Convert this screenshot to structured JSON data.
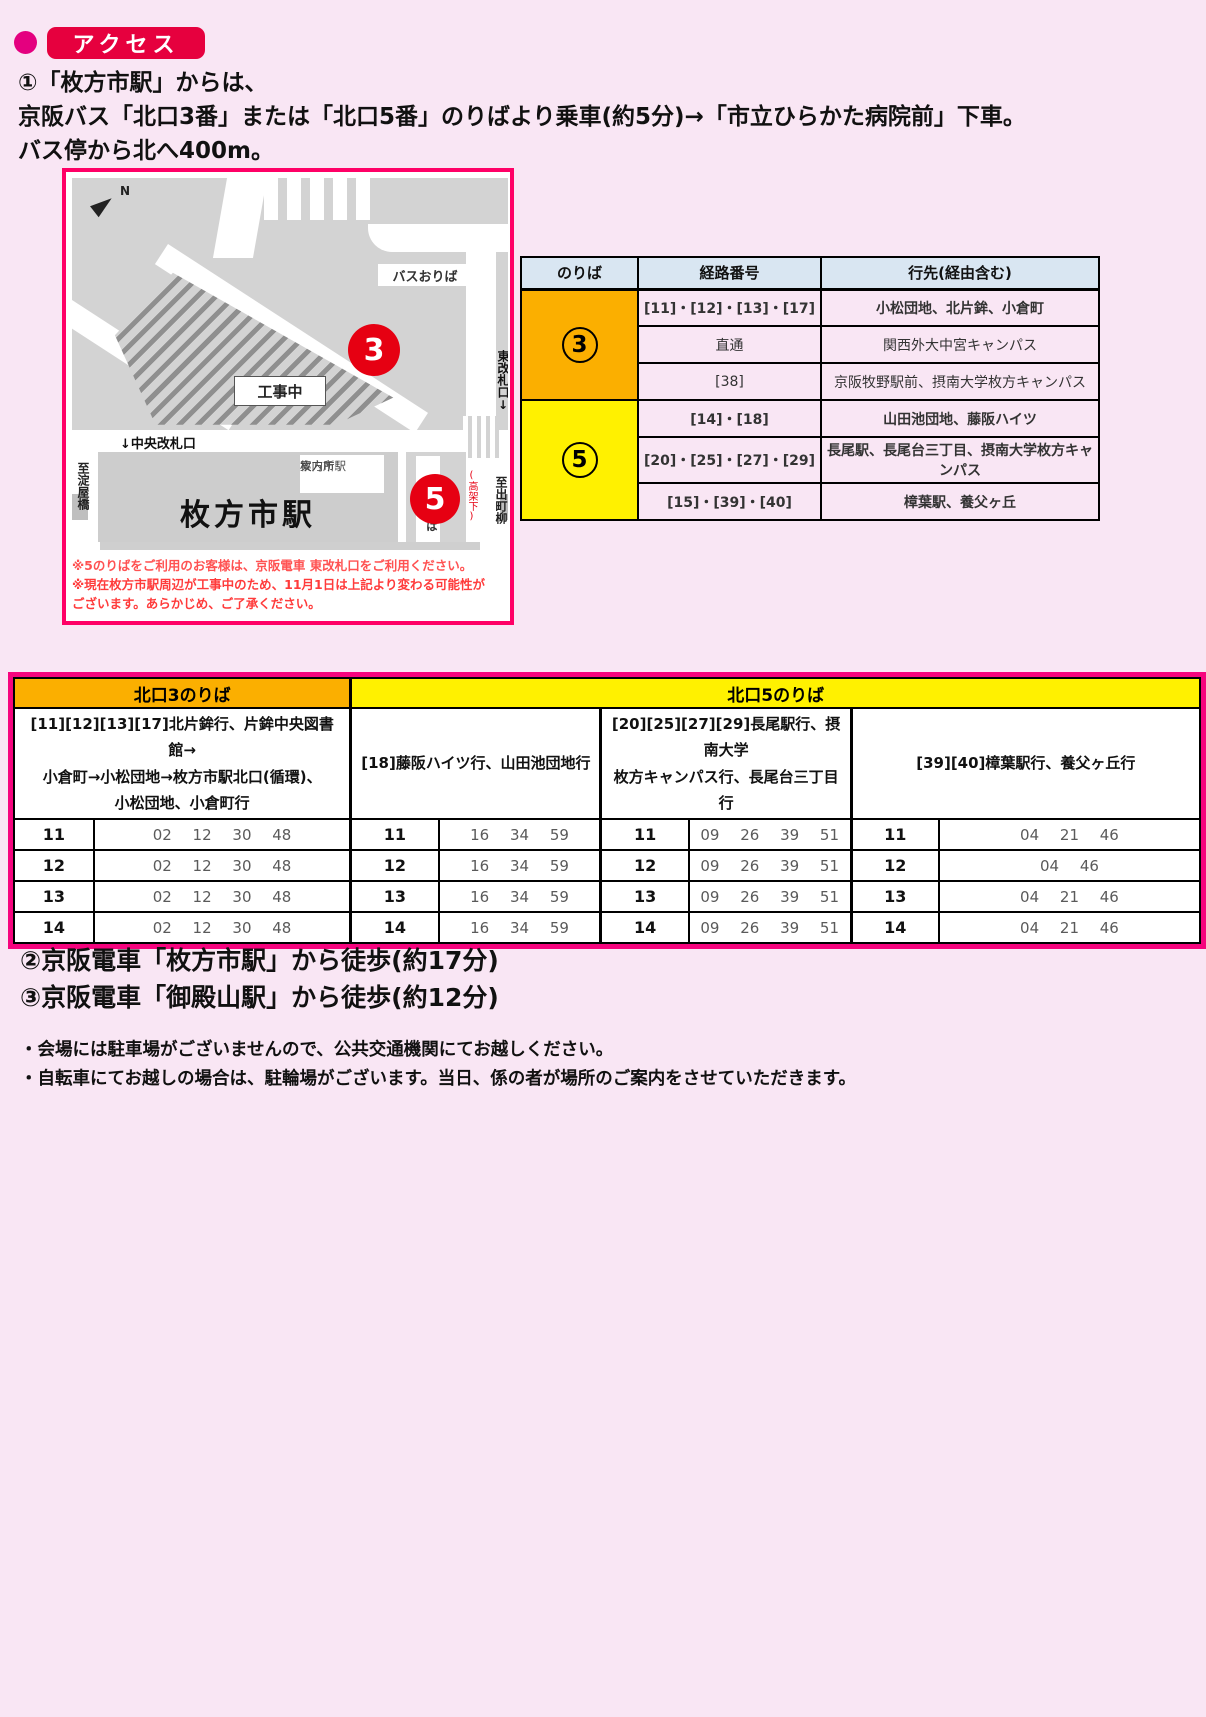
{
  "header": {
    "title": "アクセス"
  },
  "intro": {
    "line1": "①「枚方市駅」からは、",
    "line2": "京阪バス「北口3番」または「北口5番」のりばより乗車(約5分)→「市立ひらかた病院前」下車。",
    "line3": "バス停から北へ400m。"
  },
  "station_map": {
    "north_label": "N",
    "bus_dropoff_top": "バスおりば",
    "stop3_number": "3",
    "construction_label": "工事中",
    "central_gate_label": "↓中央改札口",
    "east_gate_label": "東改札口↓",
    "info_center_line1": "枚方市駅",
    "info_center_line2": "案内所",
    "station_name": "枚方市駅",
    "bus_dropoff_side": "バスおりば",
    "stop5_number": "5",
    "under_viaduct": "(高架下)",
    "to_yodoyabashi": "至淀屋橋",
    "to_demachiyanagi": "至出町柳",
    "note1": "※5のりばをご利用のお客様は、京阪電車 東改札口をご利用ください。",
    "note2": "※現在枚方市駅周辺が工事中のため、11月1日は上記より変わる可能性が",
    "note3": "ございます。あらかじめ、ご了承ください。"
  },
  "route_table": {
    "col_headers": [
      "のりば",
      "経路番号",
      "行先(経由含む)"
    ],
    "stop3": {
      "number": "3",
      "rows": [
        {
          "route": "[11]・[12]・[13]・[17]",
          "dest": "小松団地、北片鉾、小倉町"
        },
        {
          "route": "直通",
          "dest": "関西外大中宮キャンパス"
        },
        {
          "route": "[38]",
          "dest": "京阪牧野駅前、摂南大学枚方キャンパス"
        }
      ]
    },
    "stop5": {
      "number": "5",
      "rows": [
        {
          "route": "[14]・[18]",
          "dest": "山田池団地、藤阪ハイツ"
        },
        {
          "route": "[20]・[25]・[27]・[29]",
          "dest": "長尾駅、長尾台三丁目、摂南大学枚方キャンパス"
        },
        {
          "route": "[15]・[39]・[40]",
          "dest": "樟葉駅、養父ヶ丘"
        }
      ]
    }
  },
  "timetable": {
    "north3_header": "北口3のりば",
    "north5_header": "北口5のりば",
    "groups": [
      {
        "desc": "[11][12][13][17]北片鉾行、片鉾中央図書館→\n小倉町→小松団地→枚方市駅北口(循環)、\n小松団地、小倉町行",
        "rows": [
          {
            "hour": "11",
            "minutes": "02 12 30 48"
          },
          {
            "hour": "12",
            "minutes": "02 12 30 48"
          },
          {
            "hour": "13",
            "minutes": "02 12 30 48"
          },
          {
            "hour": "14",
            "minutes": "02 12 30 48"
          }
        ]
      },
      {
        "desc": "[18]藤阪ハイツ行、山田池団地行",
        "rows": [
          {
            "hour": "11",
            "minutes": "16 34 59"
          },
          {
            "hour": "12",
            "minutes": "16 34 59"
          },
          {
            "hour": "13",
            "minutes": "16 34 59"
          },
          {
            "hour": "14",
            "minutes": "16 34 59"
          }
        ]
      },
      {
        "desc": "[20][25][27][29]長尾駅行、摂南大学\n枚方キャンパス行、長尾台三丁目行",
        "rows": [
          {
            "hour": "11",
            "minutes": "09 26 39 51"
          },
          {
            "hour": "12",
            "minutes": "09 26 39 51"
          },
          {
            "hour": "13",
            "minutes": "09 26 39 51"
          },
          {
            "hour": "14",
            "minutes": "09 26 39 51"
          }
        ]
      },
      {
        "desc": "[39][40]樟葉駅行、養父ヶ丘行",
        "rows": [
          {
            "hour": "11",
            "minutes": "04 21 46"
          },
          {
            "hour": "12",
            "minutes": "04 46"
          },
          {
            "hour": "13",
            "minutes": "04 21 46"
          },
          {
            "hour": "14",
            "minutes": "04 21 46"
          }
        ]
      }
    ]
  },
  "walk": {
    "line1": "②京阪電車「枚方市駅」から徒歩(約17分)",
    "line2": "③京阪電車「御殿山駅」から徒歩(約12分)"
  },
  "footer_notes": {
    "line1": "・会場には駐車場がございませんので、公共交通機関にてお越しください。",
    "line2": "・自転車にてお越しの場合は、駐輪場がございます。当日、係の者が場所のご案内をさせていただきます。"
  },
  "colors": {
    "accent_pink": "#ff0066",
    "title_red": "#e6003e",
    "bullet_pink": "#e4007f",
    "stop3_orange": "#fbaf00",
    "stop5_yellow": "#fff100",
    "table_header_blue": "#d9e6f2",
    "route_red": "#ff0000",
    "bus_stop_red": "#e60012"
  }
}
